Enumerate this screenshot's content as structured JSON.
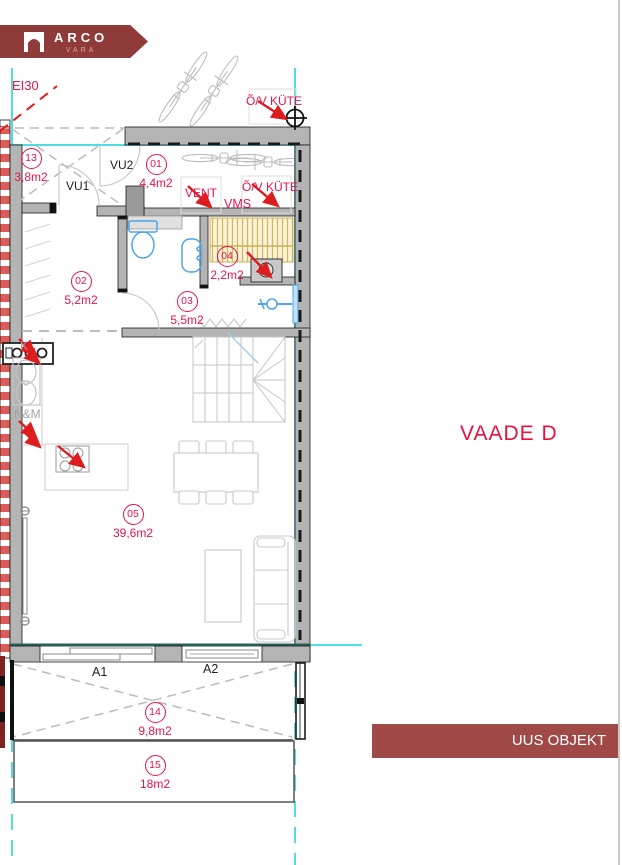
{
  "logo": {
    "line1": "ARCO",
    "line2": "VARA"
  },
  "view_title": "VAADE D",
  "status_banner": "UUS OBJEKT",
  "annotations": {
    "ei30": "EI30",
    "vu1": "VU1",
    "vu2": "VU2",
    "vent": "VENT",
    "vms": "VMS",
    "ov_kyte_top": "Õ/V KÜTE",
    "ov_kyte_inner": "Õ/V KÜTE",
    "k": "K",
    "nm": "N&M",
    "a1": "A1",
    "a2": "A2"
  },
  "rooms": [
    {
      "number": "13",
      "area": "3,8m2"
    },
    {
      "number": "01",
      "area": "4,4m2"
    },
    {
      "number": "02",
      "area": "5,2m2"
    },
    {
      "number": "03",
      "area": "5,5m2"
    },
    {
      "number": "04",
      "area": "2,2m2"
    },
    {
      "number": "05",
      "area": "39,6m2"
    },
    {
      "number": "14",
      "area": "9,8m2"
    },
    {
      "number": "15",
      "area": "18m2"
    }
  ],
  "colors": {
    "brand_red": "#8e3b3a",
    "banner_red": "#a04a48",
    "label_red": "#e8134a",
    "arrow_red": "#dd1d1d",
    "reference_cyan": "#53dbe3",
    "sill_teal": "#2a5f55",
    "wall_gray": "#b4b4b4",
    "fixture_blue": "#4fa3e8",
    "stair_hatch_yellow": "#d2b95e"
  }
}
